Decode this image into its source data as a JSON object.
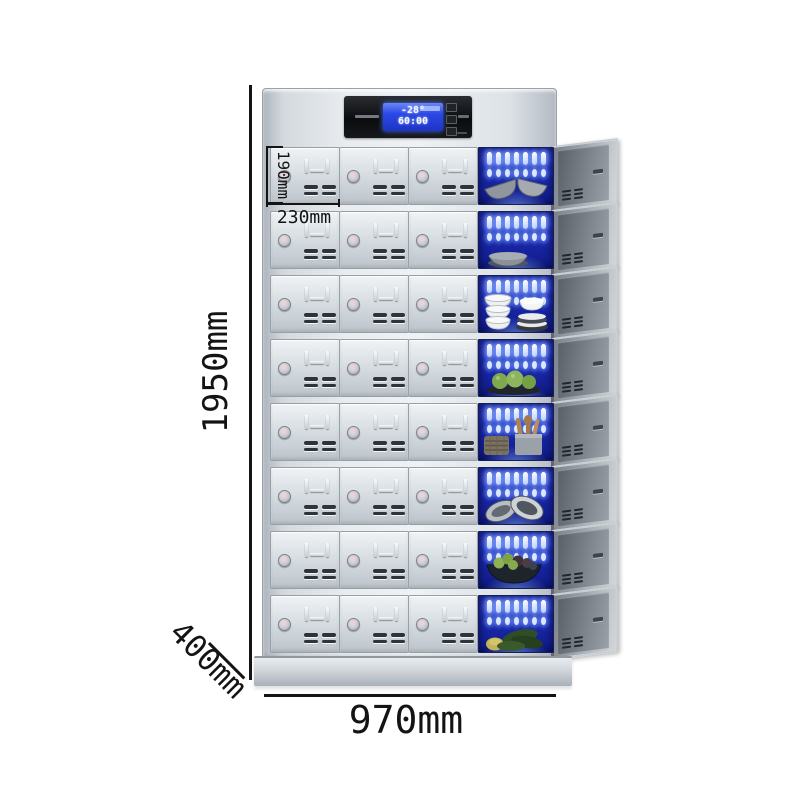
{
  "product": {
    "name": "Multi-door UV disinfection locker cabinet",
    "image_kind": "product dimension diagram"
  },
  "dimensions": {
    "overall_height": "1950mm",
    "overall_width": "970mm",
    "overall_depth": "400mm",
    "compartment_height": "190mm",
    "compartment_width": "230mm"
  },
  "control_panel": {
    "temperature": "-28°",
    "timer": "60:00"
  },
  "cabinet": {
    "rows_count": 8,
    "doors_per_row": 3,
    "open_column_position": "right",
    "rows": [
      {
        "open_contents": "grey-bowls",
        "label": "tilted grey bowls"
      },
      {
        "open_contents": "grey-bowl",
        "label": "single grey bowl"
      },
      {
        "open_contents": "white-dishes",
        "label": "stacked white bowls and plates"
      },
      {
        "open_contents": "green-fruits",
        "label": "green fruit on dark tray"
      },
      {
        "open_contents": "wooden-utensils",
        "label": "wooden utensils, holder and woven basket"
      },
      {
        "open_contents": "metal-strainers",
        "label": "metal strainers"
      },
      {
        "open_contents": "produce-basket",
        "label": "basket of mixed produce"
      },
      {
        "open_contents": "vegetables",
        "label": "green vegetables"
      }
    ]
  },
  "colors": {
    "uv_blue": "#1b29b0",
    "lamp_glow": "#cfe0ff",
    "cabinet_silver": "#d9dde2",
    "panel_black": "#0b0c0e",
    "lcd_blue": "#2c49e6",
    "annotation_text": "#141414"
  }
}
